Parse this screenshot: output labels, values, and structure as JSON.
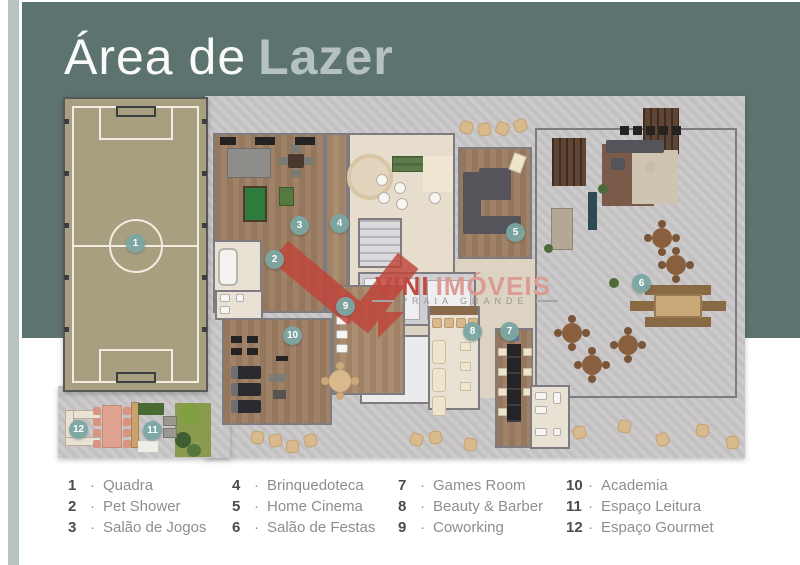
{
  "title": {
    "light": "Área de",
    "bold": "Lazer"
  },
  "watermark": {
    "brand_primary": "VINI",
    "brand_secondary": "IMÓVEIS",
    "tagline": "PRAIA GRANDE"
  },
  "plan": {
    "markers": [
      "1",
      "2",
      "3",
      "4",
      "5",
      "6",
      "7",
      "8",
      "9",
      "10",
      "11",
      "12"
    ]
  },
  "legend": {
    "separator": "·",
    "items": [
      {
        "num": "1",
        "label": "Quadra"
      },
      {
        "num": "2",
        "label": "Pet Shower"
      },
      {
        "num": "3",
        "label": "Salão de Jogos"
      },
      {
        "num": "4",
        "label": "Brinquedoteca"
      },
      {
        "num": "5",
        "label": "Home Cinema"
      },
      {
        "num": "6",
        "label": "Salão de Festas"
      },
      {
        "num": "7",
        "label": "Games Room"
      },
      {
        "num": "8",
        "label": "Beauty & Barber"
      },
      {
        "num": "9",
        "label": "Coworking"
      },
      {
        "num": "10",
        "label": "Academia"
      },
      {
        "num": "11",
        "label": "Espaço Leitura"
      },
      {
        "num": "12",
        "label": "Espaço Gourmet"
      }
    ]
  },
  "palette": {
    "panel_green": "#5d7370",
    "panel_stripe": "#b7c3c0",
    "brand_red": "#c0443a",
    "marker_teal": "#7aa6a2",
    "court_tan": "#a89f81",
    "wood_floor": "#9c7d62",
    "concrete": "#c9c6c7"
  }
}
